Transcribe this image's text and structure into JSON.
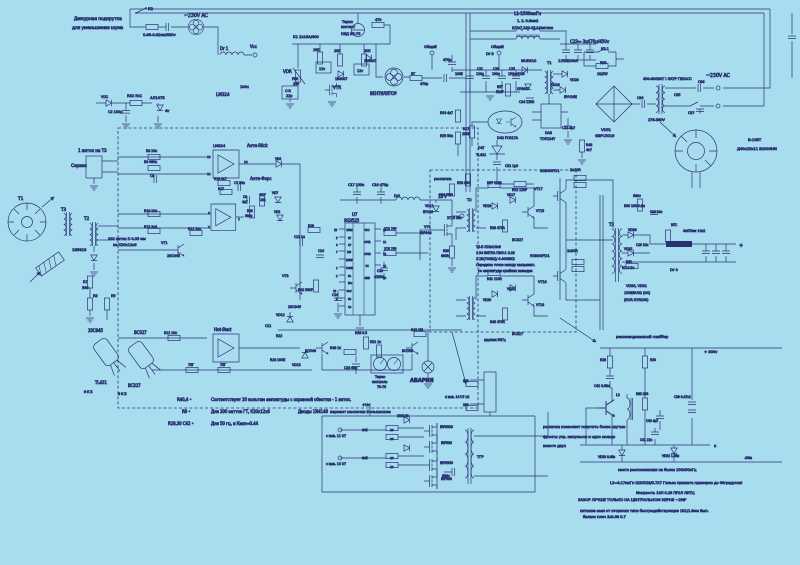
{
  "canvas": {
    "w": 800,
    "h": 565,
    "bg": "#a8ddf0"
  },
  "colors": {
    "n": "#1f2a6e",
    "b": "#2d49b4",
    "d": "#131f56",
    "ink": "#2a3372"
  },
  "title": "Схема импульсного блока питания (ИИП) с узлом дежурного вентилятора",
  "labels": [
    [
      "Дежурная подкрутка",
      74,
      20,
      4.4
    ],
    [
      "для уменьшения шума",
      72,
      29,
      4.4
    ],
    [
      "К2",
      148,
      10,
      3.8
    ],
    [
      "~230V AC",
      184,
      17,
      4.8
    ],
    [
      "0.68-0.82мк/630v",
      143,
      36,
      3.8
    ],
    [
      "Dr 1",
      220,
      50,
      4
    ],
    [
      "Vcc",
      250,
      48,
      4
    ],
    [
      "LM324",
      216,
      96,
      4.2
    ],
    [
      "100н",
      240,
      88,
      3.6
    ],
    [
      "VD1",
      101,
      98,
      3.6
    ],
    [
      "R32 5к1",
      127,
      97,
      3.8
    ],
    [
      "АЛ107Б",
      150,
      99,
      3.8
    ],
    [
      "С2 100μ",
      108,
      113,
      3.6
    ],
    [
      "4v",
      165,
      112,
      3.6
    ],
    [
      "1 виток на Т3",
      78,
      152,
      4.2
    ],
    [
      "Сервис",
      71,
      167,
      4.4
    ],
    [
      "Т1",
      18,
      200,
      4.4
    ],
    [
      "Т3",
      61,
      211,
      4.2
    ],
    [
      "Т2",
      84,
      220,
      4.2
    ],
    [
      "1N5819",
      72,
      251,
      3.8
    ],
    [
      "302 витка D 0.35 мм",
      108,
      240,
      3.7
    ],
    [
      "на К20х12х6",
      113,
      246,
      3.7
    ],
    [
      "R7",
      83,
      283,
      3.6
    ],
    [
      "560",
      82,
      289,
      3.6
    ],
    [
      "R3",
      93,
      297,
      3.6
    ],
    [
      "R5",
      111,
      297,
      3.6
    ],
    [
      "2SC945",
      88,
      332,
      4
    ],
    [
      "BC327",
      134,
      334,
      4
    ],
    [
      "TL431",
      95,
      384,
      4
    ],
    [
      "BC327",
      128,
      387,
      4
    ],
    [
      "Э К Б",
      84,
      393,
      3.3
    ],
    [
      "Э К Б",
      118,
      395,
      3.3
    ],
    [
      "R40,4  •",
      177,
      401,
      4,
      "b"
    ],
    [
      "Соответствует 20 вольтам амплитуды с охранной обмотки - 1 виток.",
      211,
      401,
      4,
      "b"
    ],
    [
      "R9      •",
      182,
      413,
      4,
      "b"
    ],
    [
      "Для 200 ваттов ГТ, К20х12х6",
      211,
      413,
      4,
      "b"
    ],
    [
      "Диоды 1N4148",
      298,
      413,
      4,
      "b"
    ],
    [
      "R28,30 С42  •",
      168,
      425,
      4,
      "b"
    ],
    [
      "Для 50 гц, и Кзап=0.44",
      211,
      425,
      4,
      "b"
    ],
    [
      "Термо",
      342,
      23,
      3.5
    ],
    [
      "контакт",
      341,
      28,
      3.5
    ],
    [
      "КЗД 95-75",
      341,
      35,
      3.8
    ],
    [
      "470",
      375,
      21,
      3.5
    ],
    [
      "К1 2х16А/400",
      293,
      38,
      3.8
    ],
    [
      "10К",
      313,
      51,
      3.4
    ],
    [
      "20К",
      334,
      52,
      3.4
    ],
    [
      "20К",
      364,
      52,
      3.4
    ],
    [
      "12v",
      319,
      70,
      3.4
    ],
    [
      "12v",
      357,
      72,
      3.4
    ],
    [
      "1N4007",
      335,
      80,
      3.3
    ],
    [
      "1N4007",
      364,
      62,
      3.3
    ],
    [
      "VDR",
      283,
      73,
      4.2
    ],
    [
      "FNR",
      292,
      80,
      3.3
    ],
    [
      "230",
      293,
      85,
      3.3
    ],
    [
      "C-R",
      285,
      92,
      3.5
    ],
    [
      "22р",
      286,
      97,
      3.5
    ],
    [
      "VTR",
      333,
      89,
      4.2
    ],
    [
      "ВЕНТИЛЯТОР",
      370,
      95,
      4
    ],
    [
      "RT",
      411,
      75,
      3.4
    ],
    [
      "470р",
      420,
      85,
      3.4
    ],
    [
      "470р",
      443,
      61,
      3.4
    ],
    [
      "Общий",
      424,
      48,
      3.6
    ],
    [
      "Общий",
      491,
      48,
      3.6
    ],
    [
      "L1-1500мкГн",
      514,
      15,
      4.2
    ],
    [
      "1.    2.   0.8мм2",
      517,
      22,
      3.6
    ],
    [
      "Ш7х7 120-15,14витков",
      512,
      29,
      3.6
    ],
    [
      "C23=  3х470μ/450v",
      570,
      43,
      4.2
    ],
    [
      "К1.1",
      601,
      50,
      3.6
    ],
    [
      "R58",
      600,
      64,
      3.4
    ],
    [
      "10/2W",
      597,
      75,
      3.4
    ],
    [
      "VD51",
      601,
      131,
      3.8
    ],
    [
      "GBPC5016",
      595,
      137,
      3.8
    ],
    [
      "С34",
      637,
      99,
      3.4
    ],
    [
      "400-800ВАТ ! ЛАТР ГЕХАСС",
      643,
      80,
      3.6
    ],
    [
      "278-380V",
      648,
      121,
      3.6
    ],
    [
      "С35",
      674,
      96,
      3.4
    ],
    [
      "~230V AC",
      706,
      77,
      4.8
    ],
    [
      "С36",
      698,
      83,
      3.4
    ],
    [
      "С37",
      688,
      114,
      3.4
    ],
    [
      "В-10ВТ",
      748,
      141,
      3.8
    ],
    [
      "Д40х25х11 В2000НМ",
      737,
      150,
      3.8
    ],
    [
      "Dr 3",
      486,
      55,
      3.8
    ],
    [
      "100Е",
      455,
      75,
      3.2
    ],
    [
      "С21",
      477,
      70,
      3.2
    ],
    [
      "120μ",
      476,
      75,
      3.2
    ],
    [
      "С26",
      493,
      70,
      3.2
    ],
    [
      "100н",
      492,
      75,
      3.2
    ],
    [
      "С25",
      509,
      70,
      3.2
    ],
    [
      "150μ",
      508,
      75,
      3.2
    ],
    [
      "R57",
      497,
      88,
      3.2
    ],
    [
      "510Р",
      496,
      93,
      3.2
    ],
    [
      "MUR810",
      521,
      62,
      3.8
    ],
    [
      "VD29",
      516,
      75,
      3.3
    ],
    [
      "Т1",
      547,
      64,
      3.8
    ],
    [
      "1.5KE200A",
      558,
      62,
      3.8
    ],
    [
      "VD28",
      570,
      81,
      3.3
    ],
    [
      "VD26",
      551,
      86,
      3.3
    ],
    [
      "BYV26E",
      564,
      98,
      3.5
    ],
    [
      "UF4007",
      517,
      90,
      3.3
    ],
    [
      "С24 120н",
      519,
      103,
      3.3
    ],
    [
      "R17",
      463,
      130,
      3.3
    ],
    [
      "230Р",
      462,
      135,
      3.3
    ],
    [
      "R54 4к7",
      440,
      114,
      3.3
    ],
    [
      "R55 56к",
      440,
      137,
      3.3
    ],
    [
      "R53 390",
      457,
      184,
      3.3
    ],
    [
      "R50 7М5",
      439,
      196,
      3.3
    ],
    [
      "D42  PC817A",
      497,
      139,
      3.5
    ],
    [
      "D47",
      478,
      149,
      3.3
    ],
    [
      "TL431",
      476,
      156,
      3.5
    ],
    [
      "DA3",
      545,
      134,
      3.5
    ],
    [
      "TOP224Y",
      540,
      140,
      3.5
    ],
    [
      "С22 4μ7",
      562,
      129,
      3.3
    ],
    [
      "R48",
      586,
      146,
      3.3
    ],
    [
      "4к7",
      586,
      151,
      3.3
    ],
    [
      "С31 1μ0",
      505,
      167,
      3.3
    ],
    [
      "R52 120Р",
      512,
      191,
      3.3
    ],
    [
      "LM324",
      213,
      147,
      3.8
    ],
    [
      "Анти-Stick",
      247,
      147,
      4
    ],
    [
      "13",
      207,
      158,
      3
    ],
    [
      "12",
      207,
      175,
      3
    ],
    [
      "14",
      244,
      163,
      3
    ],
    [
      "R16  4к7",
      214,
      180,
      3.2
    ],
    [
      "R17",
      218,
      190,
      3.2
    ],
    [
      "C7  33n",
      234,
      184,
      3.2
    ],
    [
      "Анти-Форс",
      250,
      180,
      4
    ],
    [
      "С8",
      243,
      198,
      3.1
    ],
    [
      "4μ7",
      242,
      203,
      3.1
    ],
    [
      "R27",
      260,
      196,
      3.1
    ],
    [
      "10к",
      260,
      201,
      3.1
    ],
    [
      "VD6",
      275,
      160,
      3.1
    ],
    [
      "VD7",
      272,
      194,
      3.1
    ],
    [
      "VD8",
      274,
      213,
      3.1
    ],
    [
      "R23",
      247,
      212,
      3.1
    ],
    [
      "680к",
      245,
      217,
      3.1
    ],
    [
      "3",
      208,
      214,
      3
    ],
    [
      "2",
      208,
      228,
      3
    ],
    [
      "1",
      238,
      220,
      3
    ],
    [
      "R8 10к",
      146,
      152,
      3.3
    ],
    [
      "R9 680к",
      144,
      163,
      3.3
    ],
    [
      "С3",
      150,
      177,
      3.3
    ],
    [
      "R10 10к",
      144,
      212,
      3.3
    ],
    [
      "R13 2к4",
      144,
      228,
      3.3
    ],
    [
      "R12 10к",
      188,
      230,
      3.3
    ],
    [
      "VT1",
      161,
      244,
      3.5
    ],
    [
      "2SC945",
      167,
      257,
      3.5
    ],
    [
      "U7",
      352,
      216,
      4
    ],
    [
      "SG3525",
      344,
      222,
      4
    ],
    [
      "SYNC",
      346.5,
      231,
      2.5
    ],
    [
      "RT",
      348,
      239,
      2.5
    ],
    [
      "CT",
      348,
      246,
      2.5
    ],
    [
      "DIS",
      347,
      253,
      2.5
    ],
    [
      "RAMP",
      346,
      261,
      2.5
    ],
    [
      "COMP",
      346,
      269,
      2.5
    ],
    [
      "IN-",
      348,
      277,
      2.5
    ],
    [
      "IN+",
      348,
      284,
      2.5
    ],
    [
      "Uref",
      346.5,
      292,
      2.5
    ],
    [
      "SS",
      348,
      300,
      2.5
    ],
    [
      "CS",
      348,
      308,
      2.5
    ],
    [
      "VCC",
      364.5,
      231,
      2.5
    ],
    [
      "OUTA",
      364,
      243,
      2.5
    ],
    [
      "OUTB",
      364,
      255,
      2.5
    ],
    [
      "VC",
      365.5,
      267,
      2.5
    ],
    [
      "GND",
      364.5,
      279,
      2.5
    ],
    [
      "15",
      334,
      231,
      2.6
    ],
    [
      "5",
      336,
      239,
      2.6
    ],
    [
      "6",
      336,
      246,
      2.6
    ],
    [
      "7",
      336,
      253,
      2.6
    ],
    [
      "1",
      336,
      269,
      2.6
    ],
    [
      "2",
      336,
      277,
      2.6
    ],
    [
      "16",
      333,
      292,
      2.6
    ],
    [
      "8",
      336,
      300,
      2.6
    ],
    [
      "13",
      383,
      231,
      2.6
    ],
    [
      "11",
      383,
      243,
      2.6
    ],
    [
      "14",
      383,
      255,
      2.6
    ],
    [
      "12",
      383,
      267,
      2.6
    ],
    [
      "10",
      383,
      279,
      2.6
    ],
    [
      "ХТ3  75Р",
      384,
      230,
      3.2
    ],
    [
      "ХТ4  75Р",
      384,
      250,
      3.2
    ],
    [
      "С19",
      377,
      272,
      3.2
    ],
    [
      "47/50в",
      374,
      278,
      3.2
    ],
    [
      "R29",
      308,
      227,
      3.2
    ],
    [
      "С12 1н",
      294,
      238,
      3.2
    ],
    [
      "С14",
      318,
      252,
      3.2
    ],
    [
      "С16",
      332,
      296,
      3.3
    ],
    [
      "VT3",
      282,
      277,
      3.5
    ],
    [
      "R32 560Р",
      298,
      291,
      3.3
    ],
    [
      "2SC945",
      288,
      308,
      3.5
    ],
    [
      "Hot-Start",
      214,
      331,
      4
    ],
    [
      "R12 10к",
      164,
      334,
      3.3
    ],
    [
      "75Г",
      188,
      366,
      3.3
    ],
    [
      "75Г",
      220,
      366,
      3.3
    ],
    [
      "VD12",
      276,
      316,
      3.3
    ],
    [
      "С11",
      265,
      327,
      3.3
    ],
    [
      "R22",
      276,
      337,
      3.3
    ],
    [
      "R28 100Е",
      270,
      361,
      3.3
    ],
    [
      "VD13",
      292,
      366,
      3.3
    ],
    [
      "BC546",
      305,
      352,
      3.5
    ],
    [
      "R48 1к",
      330,
      349,
      3.3
    ],
    [
      "R38 0.5",
      355,
      334,
      3.3
    ],
    [
      "R31 1к",
      370,
      343,
      3.3
    ],
    [
      "С23 68н",
      344,
      369,
      3.3
    ],
    [
      "Термо",
      375,
      378,
      3.3
    ],
    [
      "контроль",
      372,
      383,
      3.3
    ],
    [
      "70-75",
      377,
      388,
      3.3
    ],
    [
      "BC556",
      402,
      352,
      3.5
    ],
    [
      "R41 1М",
      411,
      331,
      3.3
    ],
    [
      "АВАРИЯ",
      410,
      382,
      5.2,
      "d",
      1
    ],
    [
      "раскачка",
      434,
      180,
      3.8
    ],
    [
      "С17 100н",
      348,
      186,
      3.5
    ],
    [
      "С18 470μ",
      372,
      186,
      3.5
    ],
    [
      "Dr2",
      394,
      197,
      3.5
    ],
    [
      "18 V",
      438,
      198,
      4
    ],
    [
      "VD11",
      425,
      207,
      3.3
    ],
    [
      "BYV26",
      423,
      213,
      3.3
    ],
    [
      "ХТ15  38v",
      447,
      219,
      3.3
    ],
    [
      "VT4",
      424,
      228,
      3.5
    ],
    [
      "IRF640",
      420,
      234,
      3.5
    ],
    [
      "R39",
      443,
      252,
      3.2
    ],
    [
      "680R",
      441,
      257,
      3.2
    ],
    [
      "Т2",
      467,
      201,
      3.8
    ],
    [
      "R37 120R",
      487,
      184,
      3.2
    ],
    [
      "VD18",
      483,
      207,
      3.1
    ],
    [
      "VD17",
      507,
      196,
      3.1
    ],
    [
      "VT15",
      536,
      212,
      3.3
    ],
    [
      "R38 470R",
      490,
      229,
      3.2
    ],
    [
      "BC327",
      512,
      241,
      3.5
    ],
    [
      "Т2-Б  К28х16х9",
      476,
      248,
      3.4
    ],
    [
      "1   34 ВИТКА  ПЭЛ-1 0.28",
      476,
      254,
      3.4
    ],
    [
      "2   2В(700В2)/ 4-400МК2",
      476,
      260,
      3.4
    ],
    [
      "Середина точно между выпрямит.",
      476,
      266,
      3.4
    ],
    [
      "по амплитуде крайних выводов",
      478,
      272,
      3.4
    ],
    [
      "R41 120R",
      487,
      280,
      3.2
    ],
    [
      "VD20",
      483,
      301,
      3.1
    ],
    [
      "VD21",
      507,
      290,
      3.1
    ],
    [
      "VT16",
      536,
      306,
      3.3
    ],
    [
      "R43 470R",
      490,
      323,
      3.2
    ],
    [
      "BC327",
      512,
      335,
      3.5
    ],
    [
      "S0B60PD1",
      540,
      172,
      3.9
    ],
    [
      "2х20R",
      570,
      171,
      3.5
    ],
    [
      "VT17",
      534,
      190,
      3.5
    ],
    [
      "50B60PD1",
      530,
      257,
      3.9
    ],
    [
      "2х30R",
      567,
      252,
      3.5
    ],
    [
      "VT18",
      538,
      283,
      3.5
    ],
    [
      "Т3",
      609,
      226,
      4
    ],
    [
      "560v",
      633,
      197,
      3.3
    ],
    [
      "R60 10R-0.8м",
      624,
      207,
      3.2
    ],
    [
      "С28 10н",
      650,
      213,
      3.1
    ],
    [
      "VD30",
      628,
      231,
      3.3
    ],
    [
      "VD31",
      624,
      250,
      3.3
    ],
    [
      "С29 10н",
      636,
      246,
      3.1
    ],
    [
      "R61",
      626,
      263,
      3.2
    ],
    [
      "КЛ-5 Вт",
      622,
      269,
      3.2
    ],
    [
      "Dr 4",
      670,
      271,
      3.8
    ],
    [
      "NTC",
      671,
      226,
      3.1
    ],
    [
      "4х470мк +2н2",
      683,
      232,
      3.1
    ],
    [
      "+",
      739,
      247,
      5
    ],
    [
      "VD30, VD31",
      626,
      287,
      3.6
    ],
    [
      "150EBU02 (04)",
      624,
      294,
      3.6
    ],
    [
      "(RUR HY5200)",
      624,
      301,
      3.6
    ],
    [
      "рекомендованный снаббер",
      616,
      338,
      3.8
    ],
    [
      "+Uн",
      362,
      406,
      3.5
    ],
    [
      "вариант раскачки Большакова",
      330,
      413,
      3.9
    ],
    [
      "вх1",
      362,
      431,
      3.3
    ],
    [
      "с выв. 11 U7",
      326,
      437,
      3.3
    ],
    [
      "вх2",
      362,
      459,
      3.3
    ],
    [
      "с выв. 14 U7",
      326,
      465,
      3.3
    ],
    [
      "1N4148",
      397,
      417,
      3.1
    ],
    [
      "20",
      390,
      431,
      3
    ],
    [
      "20",
      390,
      440,
      3
    ],
    [
      "20",
      390,
      459,
      3
    ],
    [
      "20",
      390,
      468,
      3
    ],
    [
      "IRF9530",
      440,
      428,
      3.3
    ],
    [
      "IRF530",
      441,
      444,
      3.3
    ],
    [
      "IRF9530",
      440,
      464,
      3.3
    ],
    [
      "IRF530",
      441,
      480,
      3.3
    ],
    [
      "ТГР",
      477,
      458,
      3.8
    ],
    [
      "680н",
      442,
      477,
      3.1
    ],
    [
      "380",
      463,
      382,
      3.1
    ],
    [
      "380",
      463,
      406,
      3.1
    ],
    [
      "к выв. 14 U7   п2",
      445,
      398,
      3.2
    ],
    [
      "кружки 50Гц",
      484,
      341,
      3.3
    ],
    [
      "раскачка позволяет получить более крутые",
      543,
      428,
      3.7,
      "b"
    ],
    [
      "фронты упр. импульсов и одно кольцо",
      543,
      438,
      3.7,
      "b"
    ],
    [
      "вместо двух",
      543,
      447,
      3.7,
      "b"
    ],
    [
      "+ 300v",
      704,
      353,
      3.8
    ],
    [
      "R28",
      600,
      361,
      3.2
    ],
    [
      "С42 0.68н",
      594,
      387,
      3.2
    ],
    [
      "R30",
      650,
      361,
      3.2
    ],
    [
      "L2",
      616,
      396,
      3.4
    ],
    [
      "R63 200",
      636,
      395,
      3.1
    ],
    [
      "С40 4μ7",
      646,
      422,
      3.1
    ],
    [
      "С41 22n",
      640,
      441,
      3.1
    ],
    [
      "С39 0.47х2",
      674,
      398,
      3.1
    ],
    [
      "VD33 6.48в",
      598,
      458,
      3.1
    ],
    [
      "VD32 1.68в",
      662,
      457,
      3.1
    ],
    [
      "к",
      714,
      447,
      3.8
    ],
    [
      "-38в",
      744,
      459,
      3.8
    ],
    [
      "место расположения на балке 150А50кГц",
      618,
      471,
      3.7,
      "b"
    ],
    [
      "L2=8.17мкГн Ш20Х28/5.7Х7  Гильза прижата примерно до 60градусов!",
      610,
      484,
      3.7,
      "b"
    ],
    [
      "Мощность   10Л 0.28 ПР2Л ЛИТЦ",
      636,
      494,
      3.7,
      "b"
    ],
    [
      "ЗАЗОР ЛУЧШЕ ТОЛЬКО НА ЦЕНТРАЛЬНОМ КЕРНЕ ~2МР",
      578,
      501,
      3.9,
      "d"
    ],
    [
      "питание взял от  вторички  типа быстродействующие 1В1/1.8мм Вып.",
      580,
      512,
      3.7,
      "b"
    ],
    [
      "баланс плеч 2х0.68 0.7",
      583,
      518,
      3.7,
      "b"
    ]
  ]
}
